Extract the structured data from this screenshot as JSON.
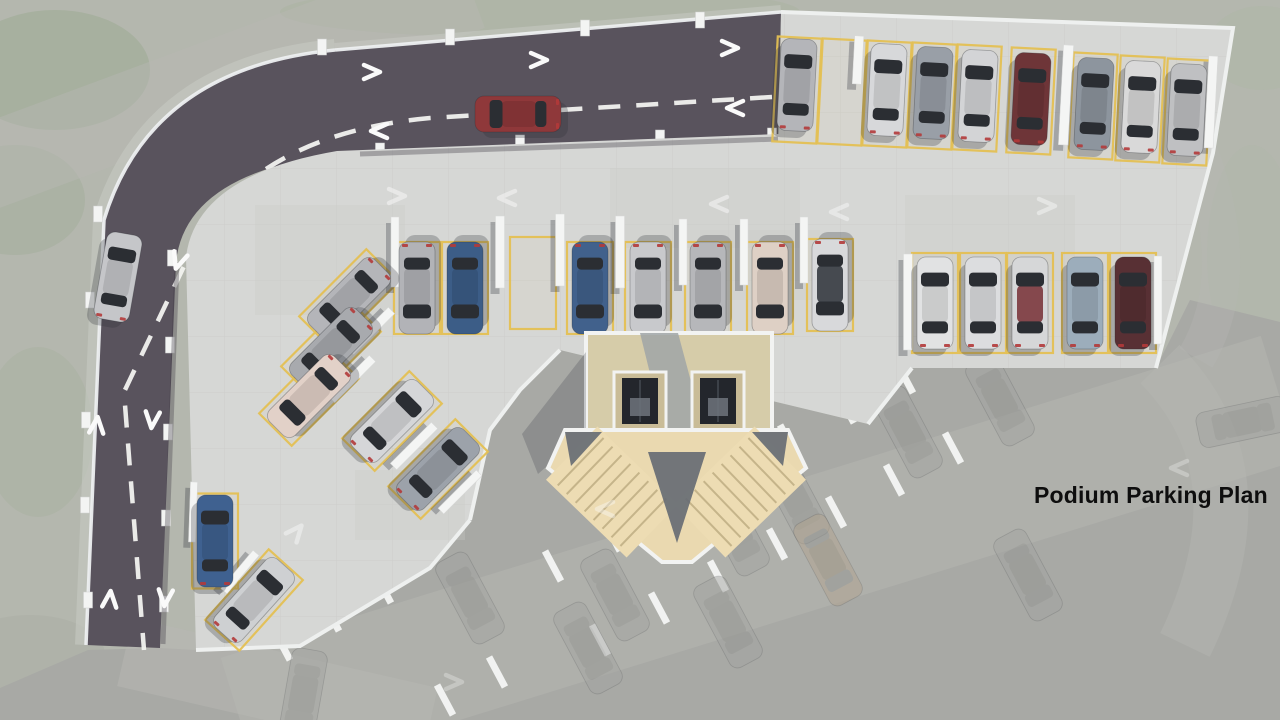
{
  "title": "Podium Parking Plan",
  "palette": {
    "landscape": "#b4b7ae",
    "ground_level": "#a8a9a5",
    "asphalt": "#59535d",
    "deck_concrete": "#d6d7d5",
    "deck_grid": "#c6c7c5",
    "stall_yellow": "#e4c054",
    "wall_white": "#f4f5f4",
    "curb_white": "#edeff0",
    "stair_beige": "#ead9b0",
    "elevator_pit": "#23262c",
    "marking_white": "#f2f2ef"
  },
  "scene": {
    "bg": "#b4b7ae",
    "blobs": [
      [
        55,
        70,
        95,
        60,
        "#9dab94",
        0.55
      ],
      [
        15,
        200,
        70,
        55,
        "#a2ae9a",
        0.5
      ],
      [
        38,
        432,
        55,
        85,
        "#a6b19d",
        0.42
      ],
      [
        30,
        655,
        75,
        40,
        "#a9aea3",
        0.5
      ],
      [
        540,
        12,
        260,
        26,
        "#aab3a0",
        0.5
      ],
      [
        1262,
        48,
        55,
        42,
        "#aeb8a6",
        0.5
      ],
      [
        1252,
        255,
        45,
        110,
        "#b1b9a9",
        0.38
      ],
      [
        1008,
        578,
        80,
        50,
        "#97a388",
        0.5
      ],
      [
        1122,
        548,
        70,
        45,
        "#9aa78c",
        0.5
      ],
      [
        1232,
        602,
        85,
        60,
        "#93a086",
        0.55
      ],
      [
        1098,
        672,
        115,
        48,
        "#9aa68e",
        0.5
      ],
      [
        872,
        700,
        90,
        40,
        "#a0ab94",
        0.45
      ],
      [
        1270,
        478,
        40,
        62,
        "#a3ae97",
        0.4
      ]
    ],
    "palm": {
      "x": 1137,
      "y": 600,
      "r": 46,
      "n": 14,
      "c": "#7f9072",
      "o": 0.5
    },
    "ground": {
      "pts": "0,688 88,650 160,648 196,650 300,646 430,568 470,520 490,430 520,390 560,350 868,424 912,368 1156,368 1190,300 1280,322 1280,720 0,720",
      "fill": "#a8a9a5"
    },
    "ghost_roads": [
      {
        "d": "M 240 720 L 1280 398",
        "w": 130,
        "o": 0.45
      },
      {
        "d": "M 125 652 L 430 722",
        "w": 70,
        "o": 0.5
      },
      {
        "d": "M 1160 364 C 1225 430 1245 520 1185 645",
        "w": 55,
        "o": 0.4
      },
      {
        "d": "M 470 -12 L -20 170",
        "w": 85,
        "o": 0.45
      },
      {
        "d": "M 1199 152 C 1228 230 1230 300 1196 358",
        "w": 38,
        "o": 0.32
      }
    ],
    "ghost_road_color": "#b7b8b3",
    "ghost_walls": [
      [
        905,
        378
      ],
      [
        846,
        408
      ],
      [
        788,
        440
      ],
      [
        729,
        472
      ],
      [
        670,
        504
      ],
      [
        612,
        536
      ],
      [
        553,
        566
      ],
      [
        953,
        448
      ],
      [
        894,
        480
      ],
      [
        836,
        512
      ],
      [
        777,
        544
      ],
      [
        718,
        576
      ],
      [
        659,
        608
      ],
      [
        600,
        640
      ],
      [
        383,
        588
      ],
      [
        331,
        616
      ],
      [
        497,
        672
      ],
      [
        445,
        700
      ],
      [
        282,
        645
      ]
    ],
    "ghost_wall_angle": -28,
    "ghost_cars": [
      {
        "x": 908,
        "y": 432
      },
      {
        "x": 795,
        "y": 498
      },
      {
        "x": 735,
        "y": 530
      },
      {
        "x": 615,
        "y": 595
      },
      {
        "x": 1028,
        "y": 575
      },
      {
        "x": 470,
        "y": 598
      },
      {
        "x": 303,
        "y": 695,
        "a": 190
      },
      {
        "x": 1243,
        "y": 422,
        "a": 78
      },
      {
        "x": 828,
        "y": 560,
        "c": "#b2a490"
      },
      {
        "x": 728,
        "y": 622
      },
      {
        "x": 588,
        "y": 648
      },
      {
        "x": 1000,
        "y": 400
      }
    ],
    "road": {
      "fill": "#59535d",
      "d": "M 781 12 L 335 50 Q 150 68 104 220 L 86 645 L 160 648 L 176 262 Q 186 168 356 152 L 778 137 Z",
      "sidewalks": [
        {
          "d": "M 335 50 Q 150 68 104 220 L 86 645",
          "w": 22,
          "o": 0.55
        },
        {
          "d": "M 781 12 L 335 50",
          "w": 14,
          "o": 0.5
        }
      ],
      "sidewalk_color": "#c9ccc5",
      "curbs": [
        "M 335 50 Q 150 68 104 220 L 86 645",
        "M 781 12 L 335 50"
      ],
      "centerlines": [
        "M 772 97 L 430 118 Q 245 135 186 262 L 124 392 L 144 650"
      ],
      "posts": [
        [
          322,
          47
        ],
        [
          450,
          37
        ],
        [
          585,
          28
        ],
        [
          700,
          20
        ],
        [
          98,
          214
        ],
        [
          90,
          300
        ],
        [
          86,
          420
        ],
        [
          85,
          505
        ],
        [
          88,
          600
        ],
        [
          172,
          258
        ],
        [
          170,
          345
        ],
        [
          168,
          432
        ],
        [
          166,
          518
        ],
        [
          164,
          604
        ],
        [
          380,
          151
        ],
        [
          520,
          143
        ],
        [
          660,
          138
        ],
        [
          772,
          136
        ]
      ]
    },
    "deck": {
      "d": "M 337 151 L 779 134 L 781 12 L 1233 28 L 1213 153 L 1156 368 L 912 368 L 868 424 L 560 350 L 520 390 L 490 430 L 470 520 L 430 568 L 300 646 L 196 650 L 186 257 Q 196 175 337 151 Z",
      "fill": "#d6d7d5",
      "grid": "#c6c7c5",
      "patches": [
        [
          255,
          205,
          150,
          110
        ],
        [
          610,
          168,
          190,
          80
        ],
        [
          905,
          195,
          170,
          105
        ],
        [
          355,
          470,
          110,
          70
        ],
        [
          700,
          230,
          120,
          70
        ]
      ],
      "edges": [
        "M 781 12 L 1233 28 L 1213 153 L 1156 368",
        "M 912 368 L 868 424",
        "M 560 350 L 520 390 L 490 430 L 470 520",
        "M 470 520 L 430 568 L 300 646 L 196 650"
      ],
      "inner_shadows": [
        "M 778 139 L 360 154",
        "M 177 262 L 163 644"
      ]
    },
    "stalls": [
      [
        797,
        90,
        44,
        105,
        3
      ],
      [
        842,
        92,
        44,
        105,
        3
      ],
      [
        887,
        94,
        44,
        105,
        3
      ],
      [
        932,
        96,
        44,
        105,
        3
      ],
      [
        977,
        98,
        44,
        105,
        3
      ],
      [
        1031,
        101,
        44,
        105,
        3
      ],
      [
        1093,
        106,
        44,
        105,
        3
      ],
      [
        1140,
        109,
        44,
        105,
        3
      ],
      [
        1187,
        112,
        44,
        105,
        3
      ],
      [
        417,
        288,
        46,
        92,
        0
      ],
      [
        465,
        288,
        46,
        92,
        0
      ],
      [
        533,
        283,
        46,
        92,
        0
      ],
      [
        590,
        288,
        46,
        92,
        0
      ],
      [
        648,
        288,
        46,
        92,
        0
      ],
      [
        708,
        288,
        46,
        92,
        0
      ],
      [
        770,
        288,
        46,
        92,
        0
      ],
      [
        830,
        285,
        46,
        92,
        0
      ],
      [
        935,
        303,
        46,
        100,
        0
      ],
      [
        983,
        303,
        46,
        100,
        0
      ],
      [
        1030,
        303,
        46,
        100,
        0
      ],
      [
        1085,
        303,
        46,
        100,
        0
      ],
      [
        1133,
        303,
        46,
        100,
        0
      ],
      [
        349,
        299,
        46,
        95,
        45
      ],
      [
        331,
        349,
        46,
        95,
        45
      ],
      [
        309,
        396,
        46,
        95,
        45
      ],
      [
        392,
        421,
        46,
        95,
        45
      ],
      [
        438,
        469,
        46,
        95,
        45
      ],
      [
        215,
        541,
        46,
        95,
        0
      ],
      [
        254,
        600,
        46,
        95,
        42
      ]
    ],
    "walls": [
      [
        1066,
        95,
        10,
        100,
        3
      ],
      [
        858,
        60,
        9,
        48,
        3
      ],
      [
        1211,
        102,
        9,
        92,
        3
      ],
      [
        395,
        252,
        8,
        70,
        0
      ],
      [
        500,
        252,
        9,
        72,
        0
      ],
      [
        560,
        250,
        9,
        72,
        0
      ],
      [
        620,
        252,
        9,
        72,
        0
      ],
      [
        683,
        252,
        8,
        66,
        0
      ],
      [
        744,
        252,
        8,
        66,
        0
      ],
      [
        804,
        250,
        8,
        66,
        0
      ],
      [
        908,
        302,
        9,
        96,
        0
      ],
      [
        1158,
        300,
        8,
        88,
        0
      ],
      [
        371,
        331,
        9,
        58,
        45
      ],
      [
        352,
        379,
        9,
        58,
        45
      ],
      [
        414,
        446,
        9,
        58,
        45
      ],
      [
        460,
        492,
        8,
        54,
        45
      ],
      [
        240,
        572,
        8,
        50,
        40
      ],
      [
        193,
        512,
        7,
        60,
        2
      ]
    ],
    "cars": [
      {
        "x": 797,
        "y": 85,
        "a": 3,
        "c": "#b4b5b9"
      },
      {
        "x": 887,
        "y": 90,
        "a": 3,
        "c": "#d7d8da"
      },
      {
        "x": 933,
        "y": 93,
        "a": 3,
        "c": "#999fa7"
      },
      {
        "x": 978,
        "y": 96,
        "a": 3,
        "c": "#d3d4d6"
      },
      {
        "x": 1031,
        "y": 99,
        "a": 3,
        "c": "#6e3538"
      },
      {
        "x": 1094,
        "y": 104,
        "a": 3,
        "c": "#8d959e"
      },
      {
        "x": 1141,
        "y": 107,
        "a": 3,
        "c": "#d9d9d9"
      },
      {
        "x": 1187,
        "y": 110,
        "a": 3,
        "c": "#bfc0c2"
      },
      {
        "x": 417,
        "y": 288,
        "a": 180,
        "c": "#b2b3b7"
      },
      {
        "x": 465,
        "y": 288,
        "a": 180,
        "c": "#3c5d87"
      },
      {
        "x": 590,
        "y": 288,
        "a": 180,
        "c": "#41618c"
      },
      {
        "x": 648,
        "y": 288,
        "a": 180,
        "c": "#c8c9cc"
      },
      {
        "x": 708,
        "y": 288,
        "a": 180,
        "c": "#b6b7ba"
      },
      {
        "x": 770,
        "y": 288,
        "a": 180,
        "c": "#ded0c5"
      },
      {
        "x": 830,
        "y": 285,
        "a": 180,
        "c": "#d8d9db",
        "roof": "#3a3e44"
      },
      {
        "x": 935,
        "y": 303,
        "a": 0,
        "c": "#e1e2e3"
      },
      {
        "x": 983,
        "y": 303,
        "a": 0,
        "c": "#dcdddf"
      },
      {
        "x": 1030,
        "y": 303,
        "a": 0,
        "c": "#d6d7d8",
        "roof": "#7e3c41"
      },
      {
        "x": 1085,
        "y": 303,
        "a": 0,
        "c": "#9cadbb"
      },
      {
        "x": 1133,
        "y": 303,
        "a": 0,
        "c": "#583034"
      },
      {
        "x": 349,
        "y": 299,
        "a": 225,
        "c": "#b4b5b9"
      },
      {
        "x": 331,
        "y": 349,
        "a": 225,
        "c": "#a8aaae"
      },
      {
        "x": 309,
        "y": 396,
        "a": 225,
        "c": "#e2d1c8"
      },
      {
        "x": 392,
        "y": 421,
        "a": 45,
        "c": "#d5d6d8"
      },
      {
        "x": 438,
        "y": 469,
        "a": 45,
        "c": "#9ca2aa"
      },
      {
        "x": 215,
        "y": 541,
        "a": 0,
        "c": "#3f6190"
      },
      {
        "x": 254,
        "y": 600,
        "a": 42,
        "c": "#ced0d2"
      },
      {
        "x": 518,
        "y": 114,
        "a": 270,
        "c": "#8f383a",
        "l": 86
      },
      {
        "x": 118,
        "y": 277,
        "a": 10,
        "c": "#c5c6c9",
        "l": 88
      }
    ],
    "arrows": [
      [
        373,
        72,
        0,
        1
      ],
      [
        540,
        60,
        0,
        1
      ],
      [
        731,
        48,
        0,
        1
      ],
      [
        378,
        131,
        180,
        1
      ],
      [
        734,
        108,
        180,
        1
      ],
      [
        178,
        262,
        108,
        1
      ],
      [
        97,
        424,
        -85,
        1
      ],
      [
        110,
        598,
        -85,
        1
      ],
      [
        152,
        421,
        95,
        1
      ],
      [
        165,
        599,
        95,
        1
      ],
      [
        398,
        196,
        0,
        0.5
      ],
      [
        506,
        198,
        180,
        0.5
      ],
      [
        718,
        204,
        180,
        0.5
      ],
      [
        838,
        212,
        180,
        0.45
      ],
      [
        1048,
        206,
        0,
        0.45
      ],
      [
        297,
        531,
        -50,
        0.45
      ],
      [
        604,
        509,
        180,
        0.4
      ],
      [
        455,
        682,
        0,
        0.3
      ],
      [
        1178,
        468,
        180,
        0.3
      ]
    ],
    "core": {
      "floor": {
        "x": 586,
        "y": 333,
        "w": 186,
        "h": 99,
        "fill": "#d6cca9"
      },
      "corridor": {
        "pts": "640,333 678,333 704,430 664,430",
        "fill": "#a0a5a7"
      },
      "elevators": [
        {
          "x": 614,
          "y": 372
        },
        {
          "x": 692,
          "y": 372
        }
      ],
      "elev": {
        "w": 52,
        "h": 58,
        "frame": "#c9bc97",
        "pit": "#23262c",
        "car": "#6e747d",
        "cable": "#454a52"
      },
      "hall": {
        "pts": "565,430 788,430 806,468 692,562 662,562 548,468",
        "fill": "#ead9b0"
      },
      "flights": [
        {
          "x": 612,
          "y": 492,
          "w": 74,
          "h": 112,
          "a": -46
        },
        {
          "x": 740,
          "y": 492,
          "w": 74,
          "h": 112,
          "a": 46
        }
      ],
      "flight_fill": "#eddcb3",
      "tread": "#bfae83",
      "darks": [
        "648,452 706,452 677,543",
        "565,432 602,432 571,466",
        "752,432 788,432 783,466"
      ],
      "dark_fill": "#676c74",
      "shadows": [
        "614,430 666,430 618,472 566,472",
        "692,430 744,430 696,472 644,472",
        "586,352 586,432 538,474 522,434"
      ],
      "wall": "#f2f3f2"
    }
  }
}
